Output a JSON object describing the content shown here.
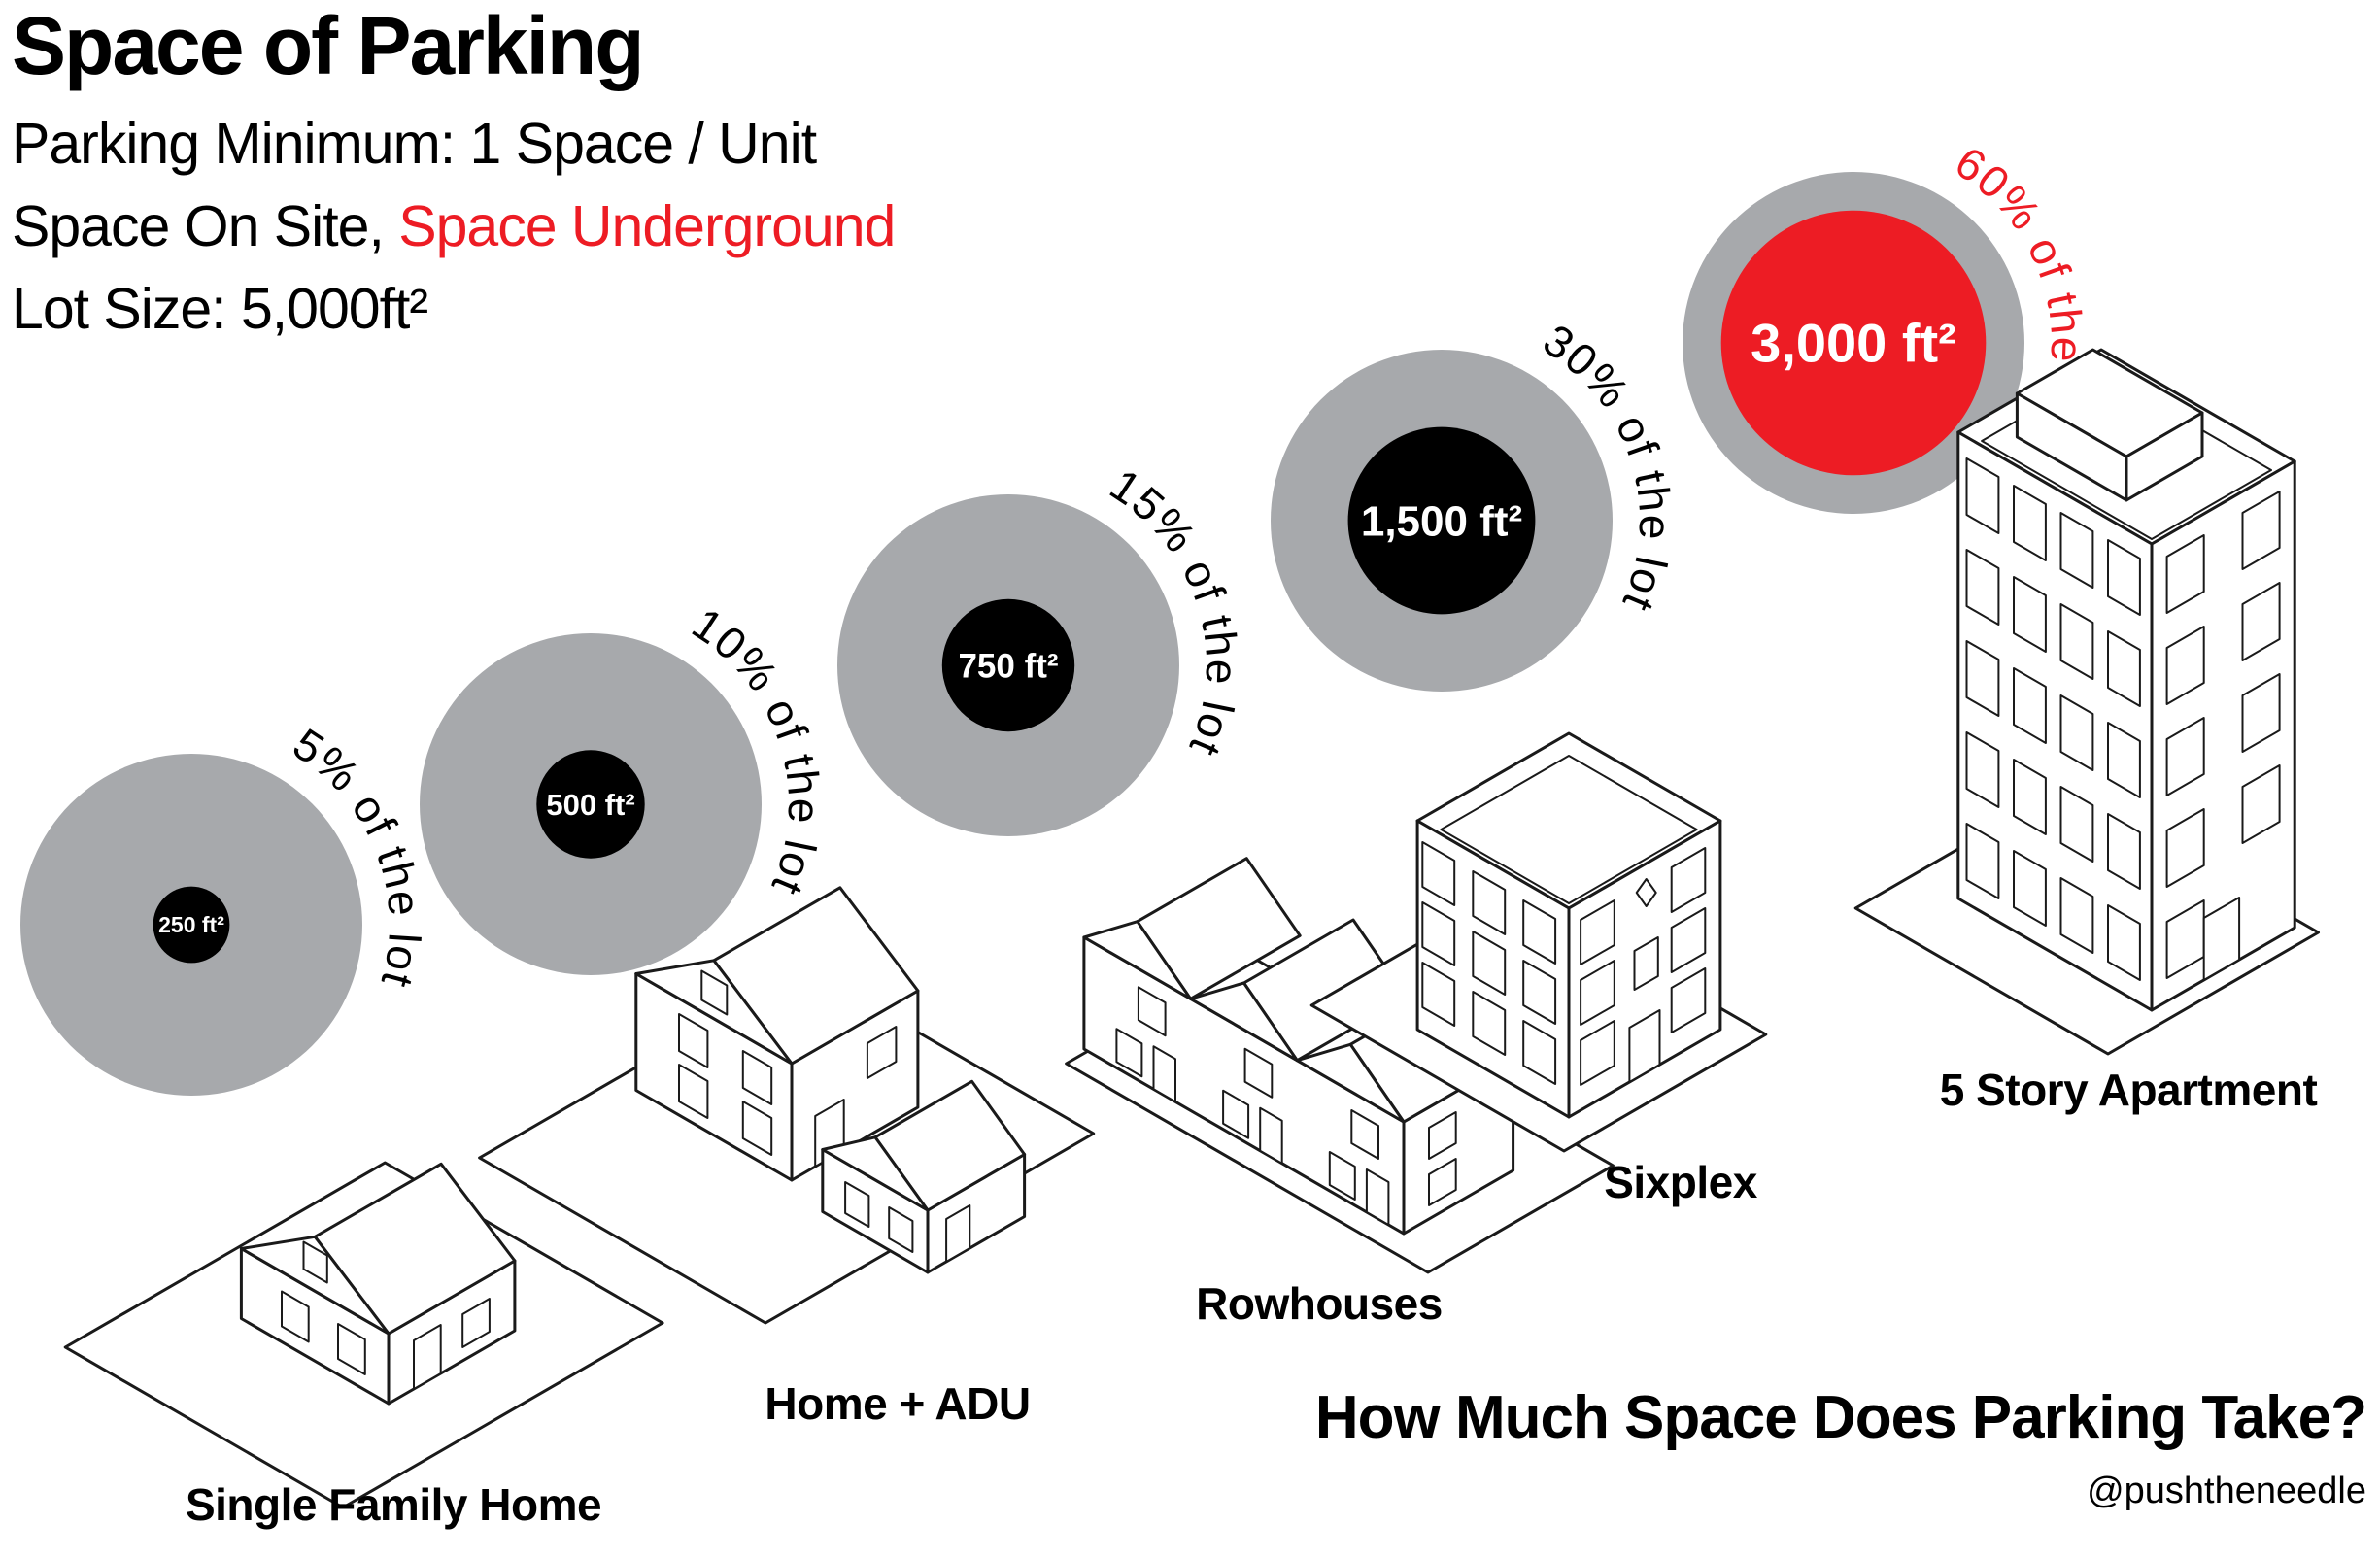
{
  "header": {
    "title": "Space of Parking",
    "subtitle_line1": "Parking Minimum: 1 Space / Unit",
    "subtitle_line2_black": "Space On Site, ",
    "subtitle_line2_red": "Space Underground",
    "subtitle_line3": "Lot Size: 5,000ft²"
  },
  "footer": {
    "question": "How Much Space Does Parking Take?",
    "credit": "@pushtheneedle"
  },
  "colors": {
    "lot_gray": "#a7a9ac",
    "parking_black": "#000000",
    "underground_red": "#ed1c24",
    "text_white": "#ffffff"
  },
  "chart_data": {
    "type": "bubble",
    "title": "Space of Parking",
    "lot_size_label": "Lot Size: 5,000ft²",
    "lot_size_ft2": 5000,
    "legend": "gray ring = 5,000 ft² lot, inner circle = parking area",
    "items": [
      {
        "building": "Single Family Home",
        "parking_area_label": "250 ft²",
        "parking_area_ft2": 250,
        "percent_label": "5% of the lot",
        "percent_of_lot": 5,
        "parking_color": "#000000",
        "percent_color": "#000000"
      },
      {
        "building": "Home + ADU",
        "parking_area_label": "500 ft²",
        "parking_area_ft2": 500,
        "percent_label": "10% of the lot",
        "percent_of_lot": 10,
        "parking_color": "#000000",
        "percent_color": "#000000"
      },
      {
        "building": "Rowhouses",
        "parking_area_label": "750 ft²",
        "parking_area_ft2": 750,
        "percent_label": "15% of the lot",
        "percent_of_lot": 15,
        "parking_color": "#000000",
        "percent_color": "#000000"
      },
      {
        "building": "Sixplex",
        "parking_area_label": "1,500 ft²",
        "parking_area_ft2": 1500,
        "percent_label": "30% of the lot",
        "percent_of_lot": 30,
        "parking_color": "#000000",
        "percent_color": "#000000"
      },
      {
        "building": "5 Story Apartment",
        "parking_area_label": "3,000 ft²",
        "parking_area_ft2": 3000,
        "percent_label": "60% of the lot",
        "percent_of_lot": 60,
        "parking_color": "#ed1c24",
        "percent_color": "#ed1c24"
      }
    ]
  }
}
